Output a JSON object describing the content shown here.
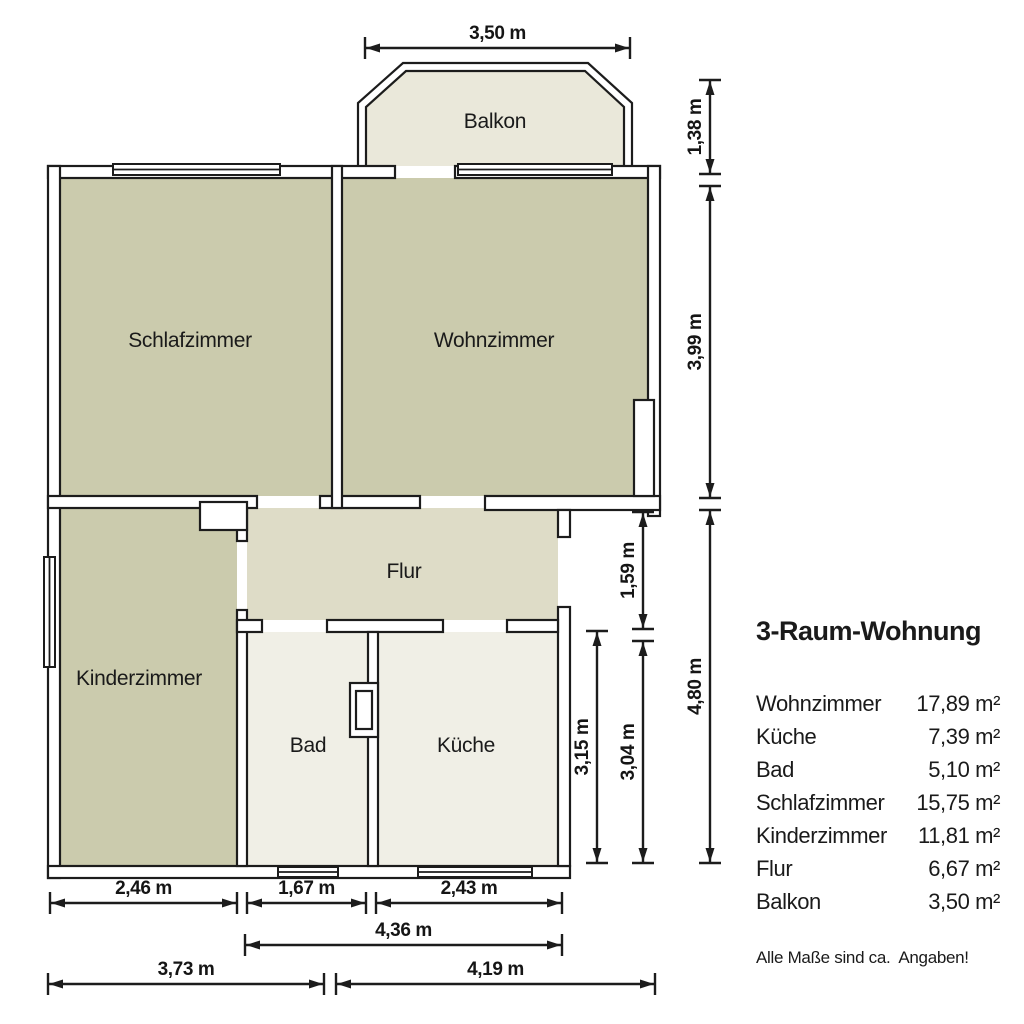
{
  "floorplan": {
    "room_labels": {
      "balkon": "Balkon",
      "schlafzimmer": "Schlafzimmer",
      "wohnzimmer": "Wohnzimmer",
      "flur": "Flur",
      "kinderzimmer": "Kinderzimmer",
      "bad": "Bad",
      "kueche": "Küche"
    },
    "dimensions": {
      "balcony_width": "3,50 m",
      "balcony_depth": "1,38 m",
      "wohnzimmer_depth": "3,99 m",
      "flur_depth": "1,59 m",
      "lower_right_total": "4,80 m",
      "kueche_depth": "3,04 m",
      "bad_depth": "3,15 m",
      "kinderzimmer_width": "2,46 m",
      "bad_width": "1,67 m",
      "kueche_width": "2,43 m",
      "bad_kueche_total": "4,36 m",
      "bottom_left_width": "3,73 m",
      "bottom_right_width": "4,19 m"
    },
    "colors": {
      "wall_line": "#1c1c1c",
      "room_main": "#cbcbad",
      "room_flur": "#dedcc7",
      "room_service": "#f0efe6",
      "room_balcony": "#eae8da"
    }
  },
  "legend": {
    "title": "3-Raum-Wohnung",
    "rows": [
      {
        "name": "Wohnzimmer",
        "area": "17,89 m²"
      },
      {
        "name": "Küche",
        "area": "7,39 m²"
      },
      {
        "name": "Bad",
        "area": "5,10 m²"
      },
      {
        "name": "Schlafzimmer",
        "area": "15,75 m²"
      },
      {
        "name": "Kinderzimmer",
        "area": "11,81 m²"
      },
      {
        "name": "Flur",
        "area": "6,67 m²"
      },
      {
        "name": "Balkon",
        "area": "3,50 m²"
      }
    ],
    "note": "Alle Maße sind ca.  Angaben!"
  }
}
